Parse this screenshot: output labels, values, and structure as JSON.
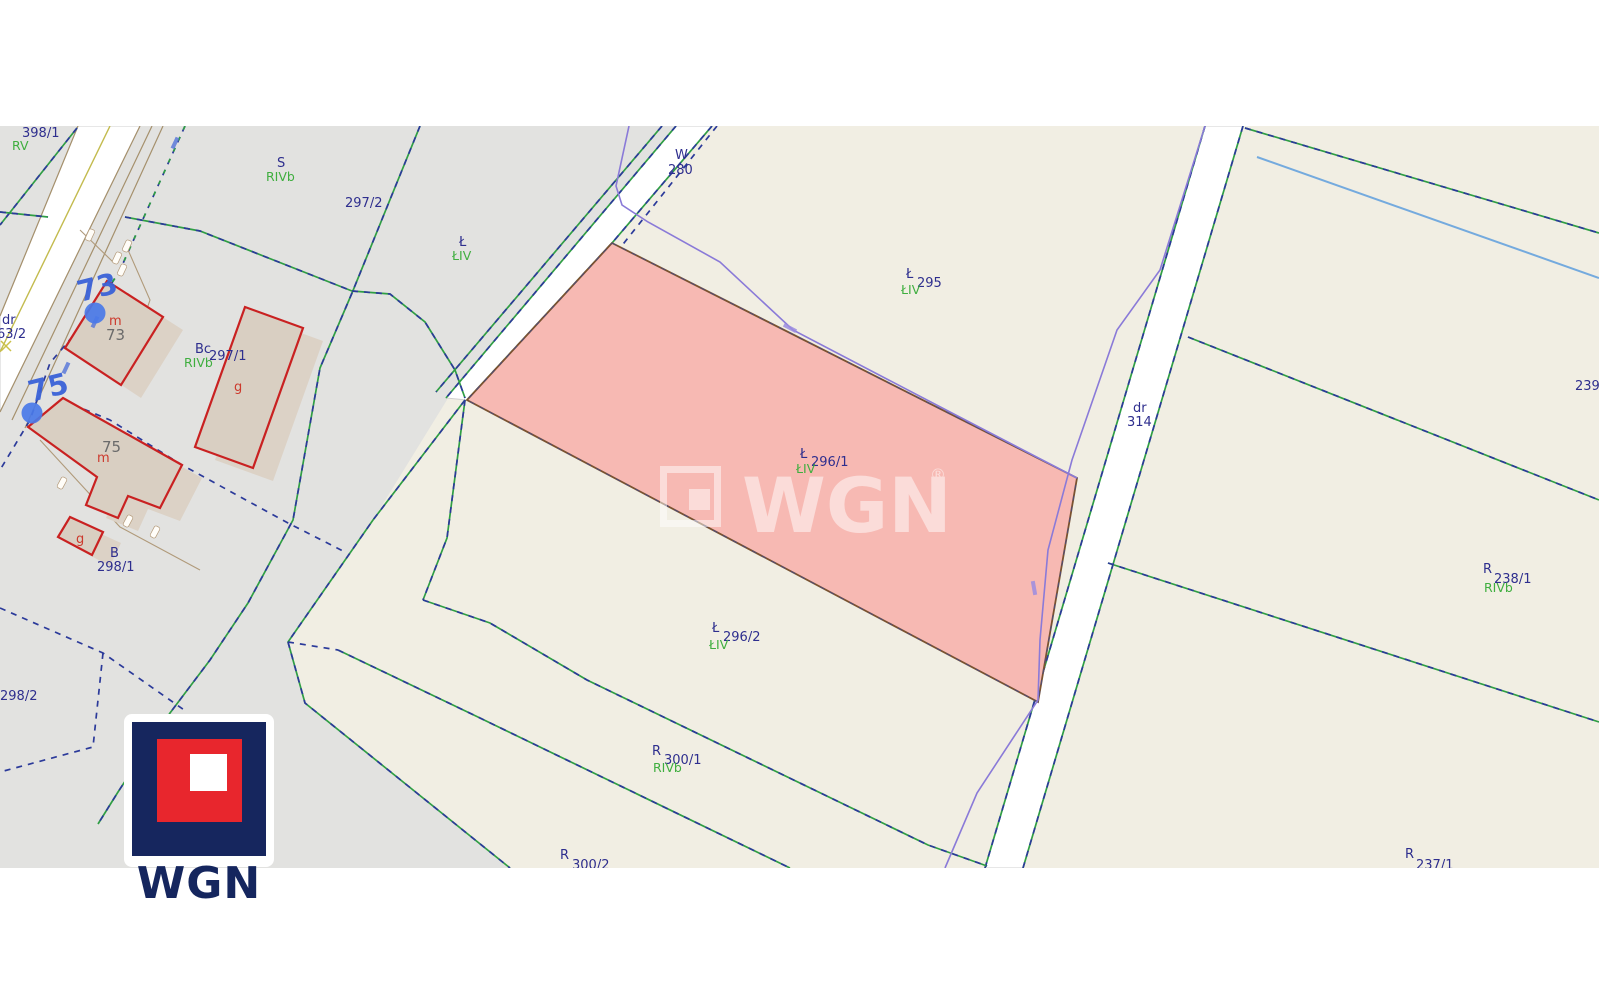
{
  "map_type": "cadastral-parcel-map",
  "colors": {
    "background_field": "#f1eee3",
    "background_grass": "#e2e2e0",
    "highlight_parcel_fill": "#f7b9b3",
    "highlight_parcel_border": "#7a5230",
    "boundary_green": "#2f9e44",
    "boundary_navy": "#2b3a9a",
    "stream_purple": "#8a7ad8",
    "water_blue": "#74aade",
    "building_outline_red": "#c92121",
    "label_navy": "#2e2e8e",
    "label_green": "#3fae3f",
    "logo_navy": "#16265e",
    "logo_red": "#e8262d"
  },
  "highlighted_parcel": "296/1",
  "labels": {
    "p398_1": "398/1",
    "p398_1_cls": "RV",
    "s_use": "S",
    "s_soil": "RIVb",
    "p297_2": "297/2",
    "l_use": "Ł",
    "l_soil": "ŁIV",
    "w_use": "W",
    "w_num": "280",
    "p295_l": "Ł",
    "p295": "295",
    "p295_soil": "ŁIV",
    "p296_1_l": "Ł",
    "p296_1": "296/1",
    "p296_1_soil": "ŁIV",
    "p296_2_l": "Ł",
    "p296_2": "296/2",
    "p296_2_soil": "ŁIV",
    "dr314_t": "dr",
    "dr314_n": "314",
    "p239": "239",
    "p238_1_l": "R",
    "p238_1": "238/1",
    "p238_1_soil": "RIVb",
    "p237_1_l": "R",
    "p237_1": "237/1",
    "p300_1_l": "R",
    "p300_1": "300/1",
    "p300_1_soil": "RIVb",
    "p300_2_l": "R",
    "p300_2": "300/2",
    "p298_1_l": "B",
    "p298_1": "298/1",
    "p298_2": "298/2",
    "dr63_t": "dr",
    "dr63_n": "63/2",
    "bc_use": "Bc",
    "p297_1": "297/1",
    "p297_1_soil": "RIVb",
    "b73_use": "m",
    "b73_num": "73",
    "b75_use": "m",
    "b75_num": "75",
    "g1": "g",
    "g2": "g",
    "addr73": "73",
    "addr75": "75"
  },
  "watermark": {
    "brand": "WGN",
    "registered": "®"
  },
  "logo": {
    "brand": "WGN"
  }
}
